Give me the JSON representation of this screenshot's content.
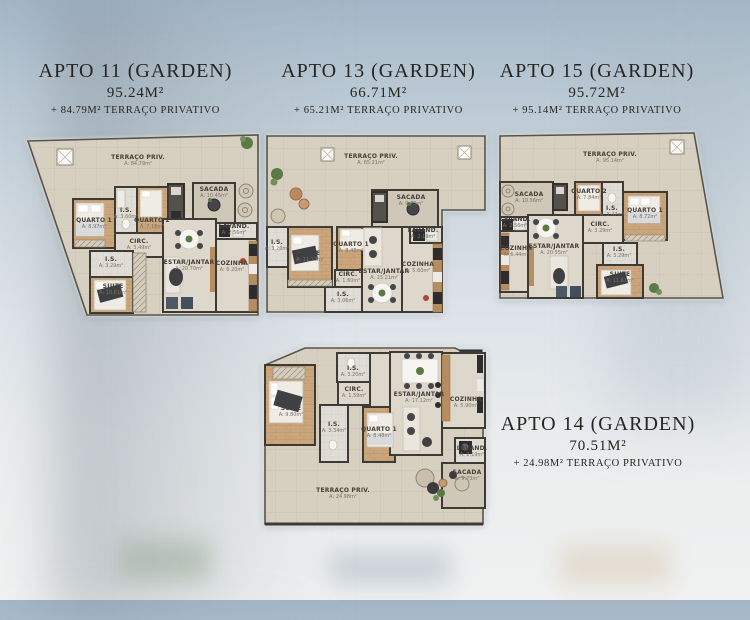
{
  "sheet": {
    "language": "pt-BR",
    "colors": {
      "wall": "#3e3a34",
      "terrace_tile": "#d7cfc0",
      "wood_floor": "#cba67c",
      "plaster_floor": "#ddd8cb",
      "accent_red": "#b5452e",
      "plant_green": "#5c7a45",
      "background_sky": "#a3b6c7",
      "title_text": "#262522"
    },
    "icons": {
      "skylight": "crossed-square",
      "plant": "green-circle-cluster",
      "dining-table": "round-table-with-chairs",
      "bed": "rect-with-pillows",
      "sofa": "rect-with-cushions",
      "washer": "dark-square-with-drum",
      "terrace-table": "round-outline-circle"
    }
  },
  "apartments": [
    {
      "id": "apto-11",
      "title": "APTO 11 (GARDEN)",
      "area": "95.24M²",
      "terrace": "+ 84.79M² TERRAÇO PRIVATIVO",
      "rooms": [
        {
          "label": "TERRAÇO PRIV.",
          "area": "A: 84.79m²"
        },
        {
          "label": "SACADA",
          "area": "A: 10.45m²"
        },
        {
          "label": "QUARTO 2",
          "area": "A: 7.16m²"
        },
        {
          "label": "I.S.",
          "area": "A: 3.60m²"
        },
        {
          "label": "QUARTO 1",
          "area": "A: 8.97m²"
        },
        {
          "label": "CIRC.",
          "area": "A: 3.49m²"
        },
        {
          "label": "LAVAND.",
          "area": "A: 2.56m²"
        },
        {
          "label": "ESTAR/JANTAR",
          "area": "A: 20.70m²"
        },
        {
          "label": "COZINHA",
          "area": "A: 6.20m²"
        },
        {
          "label": "I.S.",
          "area": "A: 3.29m²"
        },
        {
          "label": "SUITE",
          "area": "A: 10.61m²"
        }
      ]
    },
    {
      "id": "apto-13",
      "title": "APTO 13 (GARDEN)",
      "area": "66.71M²",
      "terrace": "+ 65.21M² TERRAÇO PRIVATIVO",
      "rooms": [
        {
          "label": "TERRAÇO PRIV.",
          "area": "A: 65.21m²"
        },
        {
          "label": "SACADA",
          "area": "A: 9.73m²"
        },
        {
          "label": "I.S.",
          "area": "A: 3.20m²"
        },
        {
          "label": "SUITE",
          "area": "A: 11.13m²"
        },
        {
          "label": "QUARTO 1",
          "area": "A: 8.48m²"
        },
        {
          "label": "CIRC.",
          "area": "A: 1.60m²"
        },
        {
          "label": "I.S.",
          "area": "A: 3.06m²"
        },
        {
          "label": "ESTAR/JANTAR",
          "area": "A: 15.21m²"
        },
        {
          "label": "COZINHA",
          "area": "A: 5.60m²"
        },
        {
          "label": "LAVAND.",
          "area": "A: 2.19m²"
        }
      ]
    },
    {
      "id": "apto-15",
      "title": "APTO 15 (GARDEN)",
      "area": "95.72M²",
      "terrace": "+ 95.14M² TERRAÇO PRIVATIVO",
      "rooms": [
        {
          "label": "TERRAÇO PRIV.",
          "area": "A: 95.14m²"
        },
        {
          "label": "SACADA",
          "area": "A: 10.56m²"
        },
        {
          "label": "LAVAND.",
          "area": "A: 2.56m²"
        },
        {
          "label": "COZINHA",
          "area": "A: 6.44m²"
        },
        {
          "label": "ESTAR/JANTAR",
          "area": "A: 20.55m²"
        },
        {
          "label": "QUARTO 2",
          "area": "A: 7.84m²"
        },
        {
          "label": "I.S.",
          "area": "A: 3.47m²"
        },
        {
          "label": "QUARTO 1",
          "area": "A: 8.72m²"
        },
        {
          "label": "CIRC.",
          "area": "A: 3.29m²"
        },
        {
          "label": "I.S.",
          "area": "A: 3.29m²"
        },
        {
          "label": "SUITE",
          "area": "A: 11.61m²"
        }
      ]
    },
    {
      "id": "apto-14",
      "title": "APTO 14 (GARDEN)",
      "area": "70.51M²",
      "terrace": "+ 24.98M² TERRAÇO PRIVATIVO",
      "rooms": [
        {
          "label": "SUITE",
          "area": "A: 9.80m²"
        },
        {
          "label": "I.S.",
          "area": "A: 3.20m²"
        },
        {
          "label": "CIRC.",
          "area": "A: 1.59m²"
        },
        {
          "label": "I.S.",
          "area": "A: 3.34m²"
        },
        {
          "label": "QUARTO 1",
          "area": "A: 8.48m²"
        },
        {
          "label": "ESTAR/JANTAR",
          "area": "A: 17.12m²"
        },
        {
          "label": "COZINHA",
          "area": "A: 5.90m²"
        },
        {
          "label": "LAVAND.",
          "area": "A: 2.19m²"
        },
        {
          "label": "SACADA",
          "area": "A: 9.73m²"
        },
        {
          "label": "TERRAÇO PRIV.",
          "area": "A: 24.98m²"
        }
      ]
    }
  ]
}
